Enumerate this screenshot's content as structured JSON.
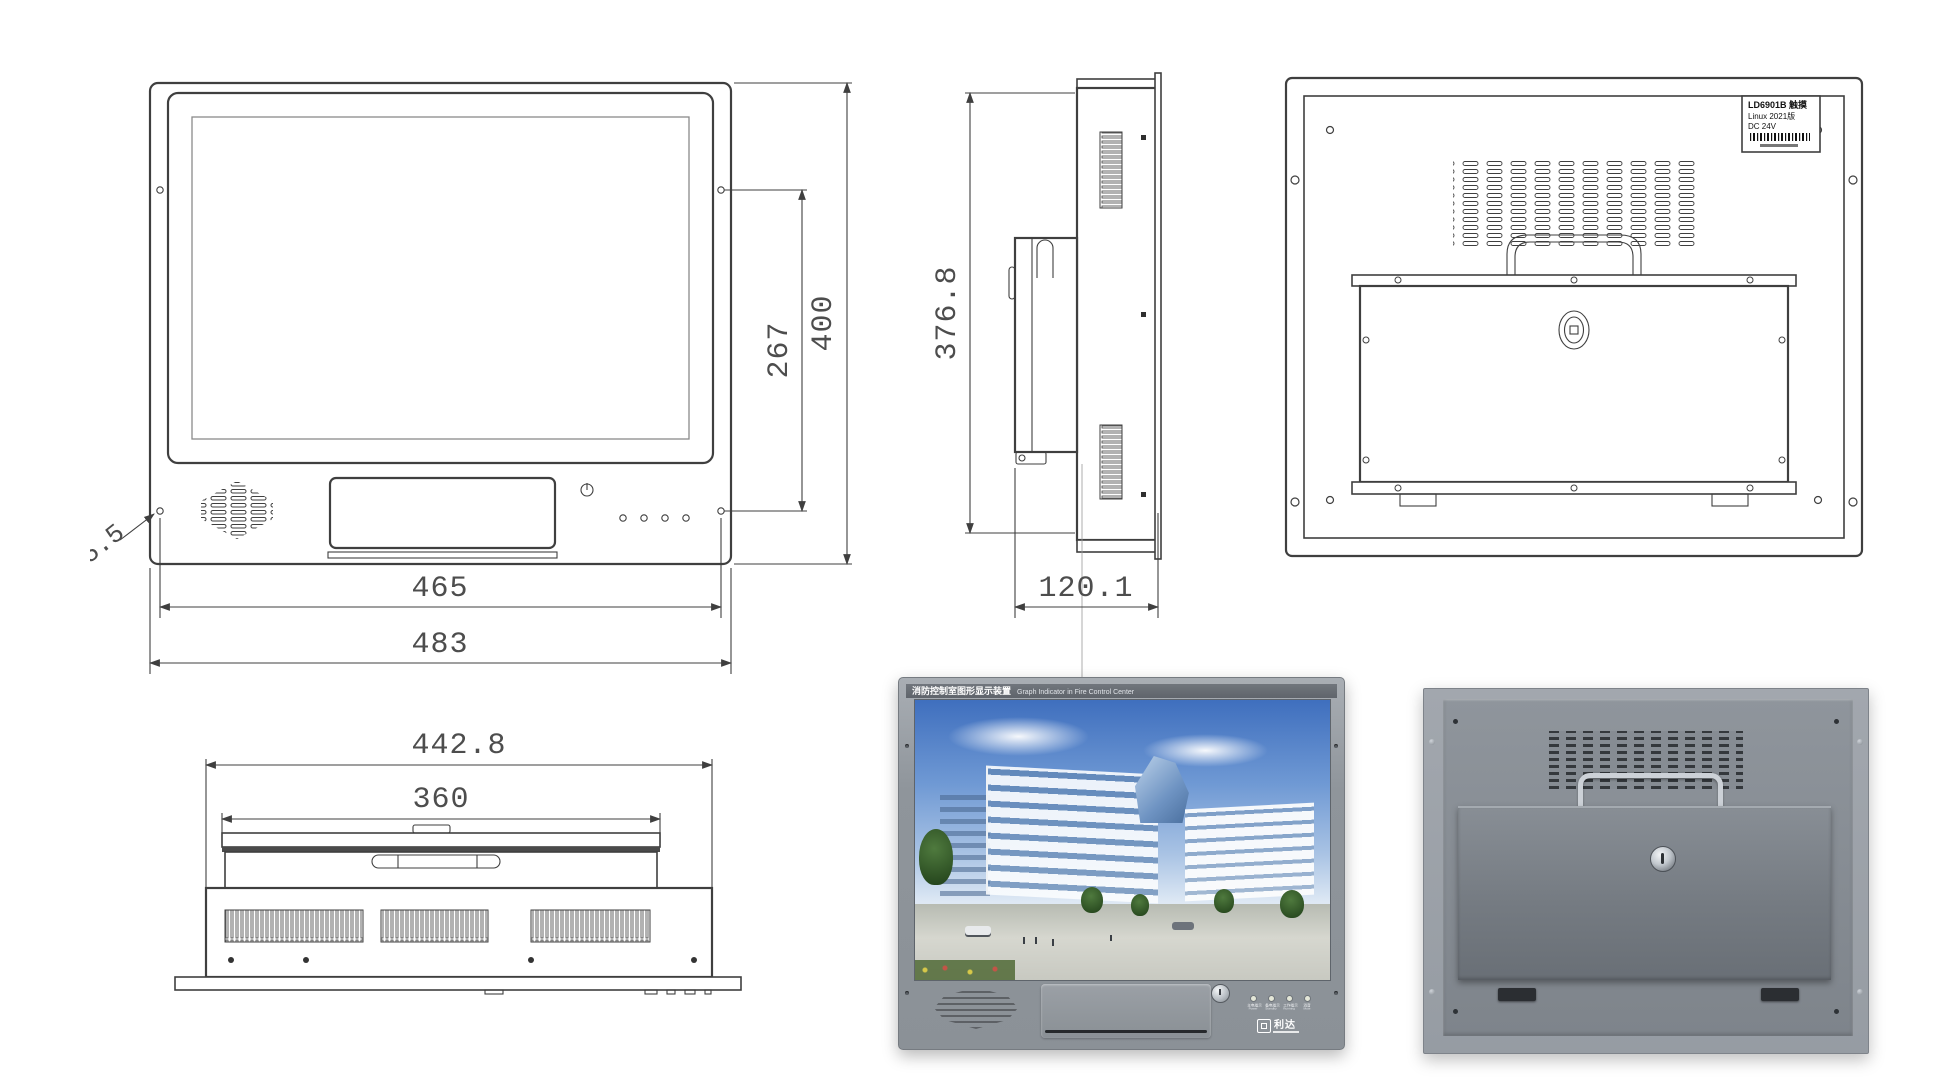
{
  "front_view": {
    "dim_width_inner": "465",
    "dim_width_outer": "483",
    "dim_hole_spacing": "267",
    "dim_height": "400",
    "hole_callout": "4-Ø5.5"
  },
  "side_view": {
    "dim_height": "376.8",
    "dim_depth": "120.1"
  },
  "back_view": {
    "label_line1": "LD6901B 触摸",
    "label_line2": "Linux 2021版",
    "label_line3": "DC 24V"
  },
  "bottom_view": {
    "dim_width_outer": "442.8",
    "dim_width_inner": "360"
  },
  "front_photo": {
    "banner_cn": "消防控制室图形显示装置",
    "banner_en": "Graph Indicator in Fire Control Center",
    "leds": [
      {
        "cn": "主电指示",
        "en": "Power"
      },
      {
        "cn": "备电指示",
        "en": "Standby"
      },
      {
        "cn": "工作指示",
        "en": "Running"
      },
      {
        "cn": "消音",
        "en": "Mute"
      }
    ],
    "logo_text": "利达"
  },
  "colors": {
    "line": "#3f3f3f",
    "dim_text": "#4d4d4d",
    "bezel_gray": "#949aa1",
    "cover_gray": "#71777e",
    "sky_blue": "#3f6fbe"
  }
}
